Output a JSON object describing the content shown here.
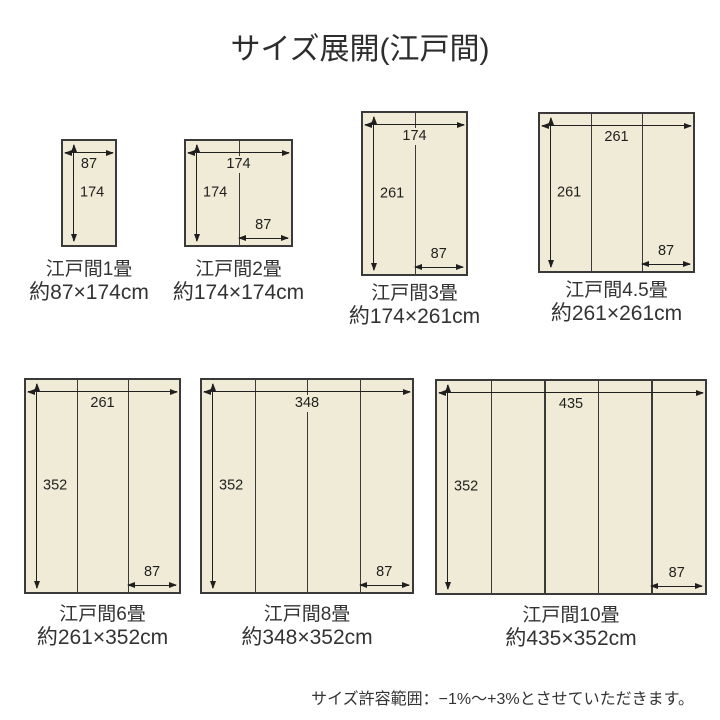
{
  "title": "サイズ展開(江戸間)",
  "note": "サイズ許容範囲：−1%〜+3%とさせていただきます。",
  "colors": {
    "mat_fill": "#efebd6",
    "mat_border": "#3a3a3a",
    "arrow": "#1f1f1f",
    "background": "#ffffff",
    "text": "#333333"
  },
  "diagrams": [
    {
      "name": "江戸間1畳",
      "size_label": "約87×174cm",
      "width_cm": "87",
      "height_cm": "174",
      "panel_cm": "87",
      "panels": 1
    },
    {
      "name": "江戸間2畳",
      "size_label": "約174×174cm",
      "width_cm": "174",
      "height_cm": "174",
      "panel_cm": "87",
      "panels": 2
    },
    {
      "name": "江戸間3畳",
      "size_label": "約174×261cm",
      "width_cm": "174",
      "height_cm": "261",
      "panel_cm": "87",
      "panels": 2
    },
    {
      "name": "江戸間4.5畳",
      "size_label": "約261×261cm",
      "width_cm": "261",
      "height_cm": "261",
      "panel_cm": "87",
      "panels": 3
    },
    {
      "name": "江戸間6畳",
      "size_label": "約261×352cm",
      "width_cm": "261",
      "height_cm": "352",
      "panel_cm": "87",
      "panels": 3
    },
    {
      "name": "江戸間8畳",
      "size_label": "約348×352cm",
      "width_cm": "348",
      "height_cm": "352",
      "panel_cm": "87",
      "panels": 4
    },
    {
      "name": "江戸間10畳",
      "size_label": "約435×352cm",
      "width_cm": "435",
      "height_cm": "352",
      "panel_cm": "87",
      "panels": 5
    }
  ]
}
